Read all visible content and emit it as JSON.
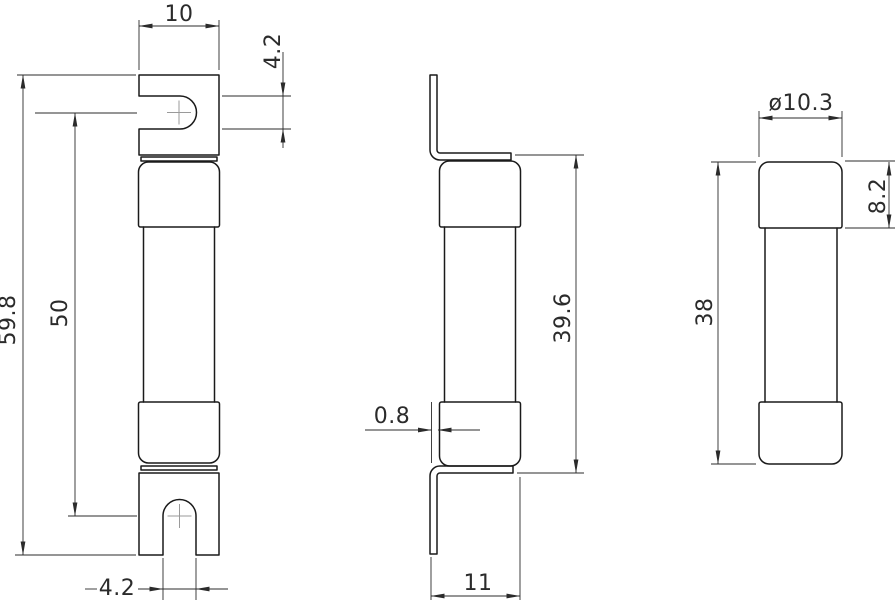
{
  "drawing": {
    "background": "#ffffff",
    "line_color": "#1a1a1a",
    "dimension_color": "#2b2b2b",
    "views": {
      "front_view": {
        "description": "front view of fuse with slotted blade terminals",
        "dimensions": {
          "blade_width": "10",
          "slot_width_top": "4.2",
          "overall_height": "59.8",
          "slot_center_distance": "50",
          "slot_width_bottom": "4.2"
        }
      },
      "side_view": {
        "description": "side view with bent blade terminals",
        "dimensions": {
          "blade_thickness": "0.8",
          "cap_to_cap_height": "39.6",
          "overall_depth": "11"
        }
      },
      "cartridge_view": {
        "description": "cartridge body without terminals",
        "dimensions": {
          "cap_diameter": "ø10.3",
          "cap_height": "8.2",
          "cartridge_length": "38"
        }
      }
    }
  }
}
